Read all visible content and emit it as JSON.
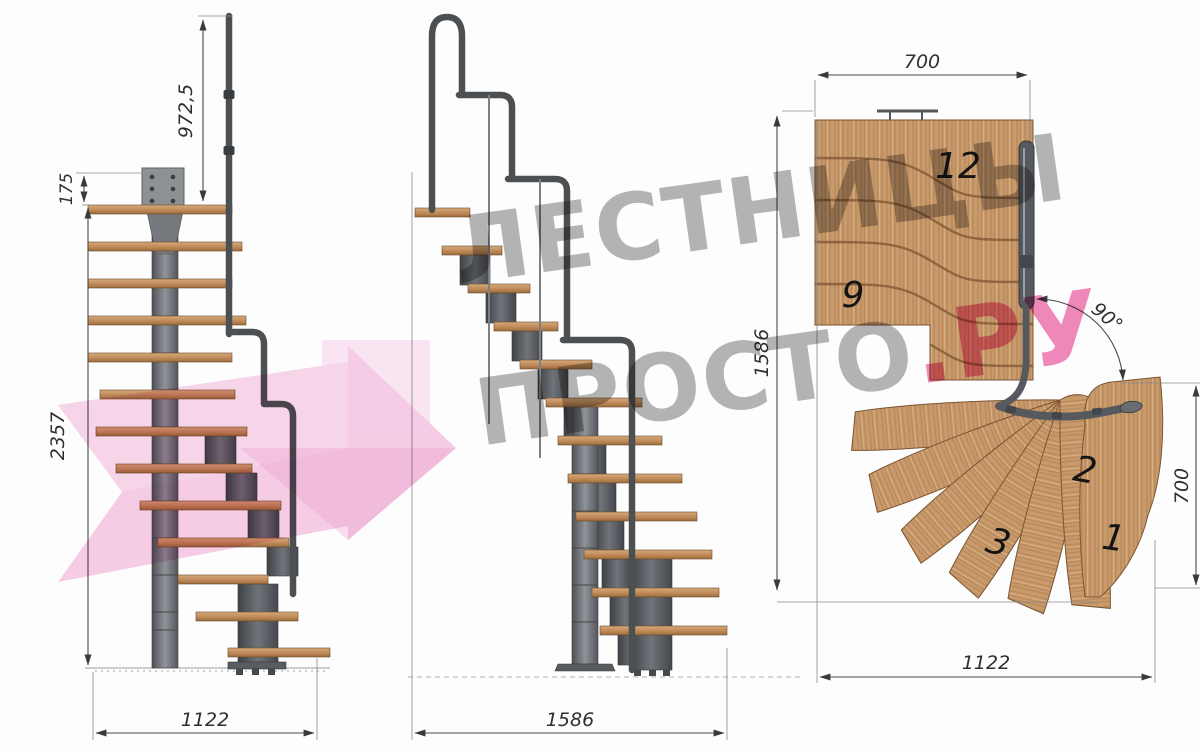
{
  "brand": {
    "line1": "ЛЕСТНИЦЫ",
    "line2_gray": "ПРОСТО",
    "line2_pink": ".РУ"
  },
  "views": {
    "front": {
      "dim_rail_height": "972,5",
      "dim_plate_offset": "175",
      "dim_total_height": "2357",
      "dim_base_width": "1122"
    },
    "side": {
      "dim_base_width": "1586"
    },
    "plan": {
      "dim_top_width": "700",
      "dim_length": "1586",
      "dim_turn_angle": "90°",
      "dim_exit_width": "700",
      "dim_bottom_width": "1122",
      "step_labels": {
        "s12": "12",
        "s9": "9",
        "s2": "2",
        "s3": "3",
        "s1": "1"
      }
    }
  },
  "colors": {
    "wood": "#c99a6c",
    "steel": "#55585b",
    "accent_pink": "#ee74ae",
    "watermark_gray": "#a8a8a8",
    "dimension": "#303030"
  }
}
